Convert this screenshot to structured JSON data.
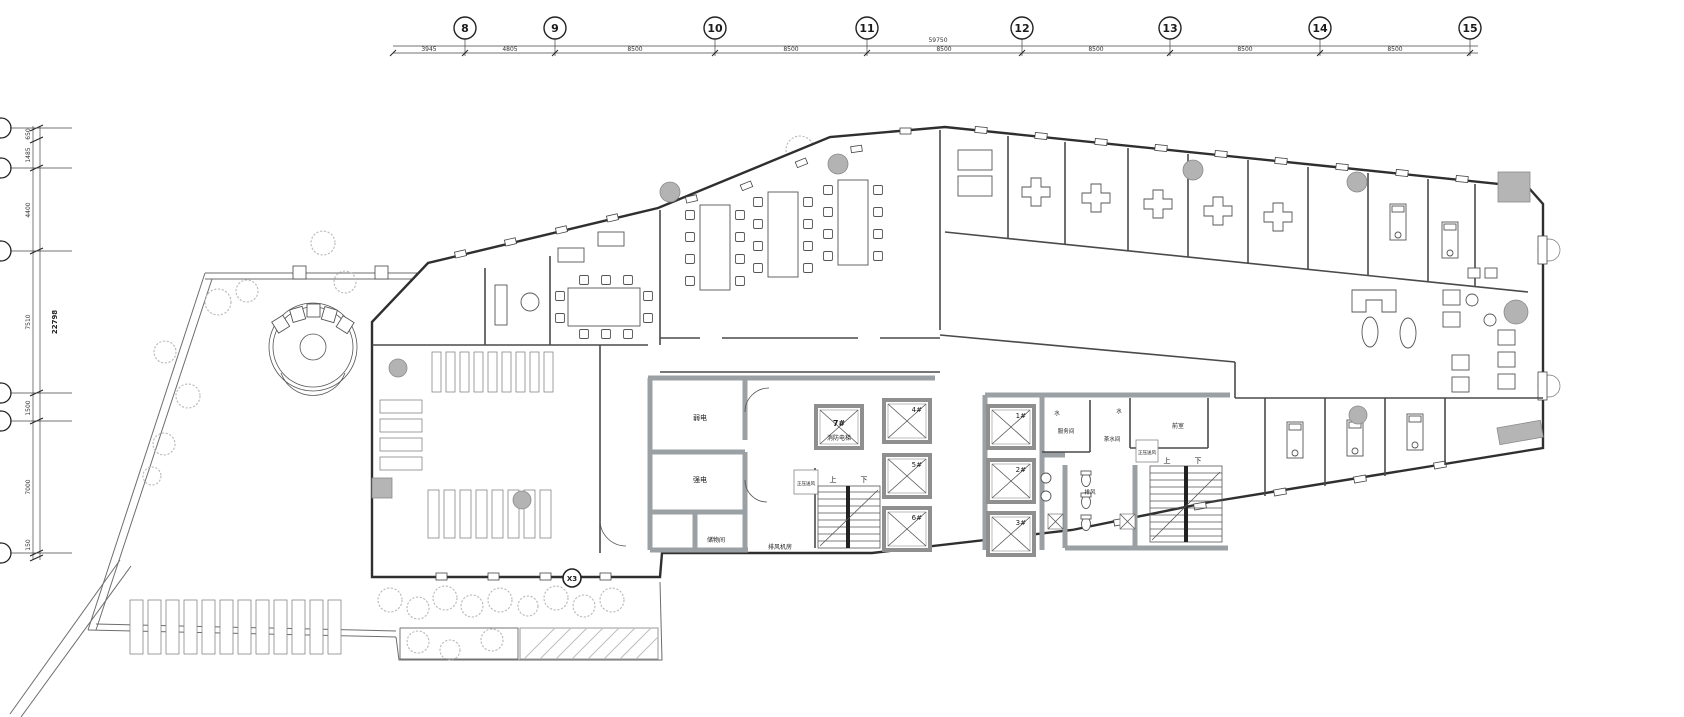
{
  "drawing": {
    "grid_top": {
      "bubbles": [
        "8",
        "9",
        "10",
        "11",
        "12",
        "13",
        "14",
        "15"
      ],
      "dims": [
        "3945",
        "4805",
        "8500",
        "8500",
        "8500",
        "8500",
        "8500",
        "8500"
      ],
      "total": "59750"
    },
    "grid_left": {
      "dims": [
        "650",
        "1485",
        "4400",
        "7510",
        "1500",
        "7000",
        "150"
      ],
      "total": "22798"
    },
    "rooms": {
      "weak_power": "弱电",
      "strong_power": "强电",
      "storage": "储物间",
      "exhaust_fan_room": "排风机房",
      "pressurized_air": "正压送风",
      "fire_elevator": "消防电梯",
      "anteroom": "前室",
      "service_room": "服务间",
      "pantry": "茶水间",
      "exhaust": "排风",
      "water": "水",
      "up": "上",
      "down": "下"
    },
    "elevators": {
      "e1": "1#",
      "e2": "2#",
      "e3": "3#",
      "e4": "4#",
      "e5": "5#",
      "e6": "6#",
      "e7": "7#"
    },
    "marker_x3": "X3"
  }
}
